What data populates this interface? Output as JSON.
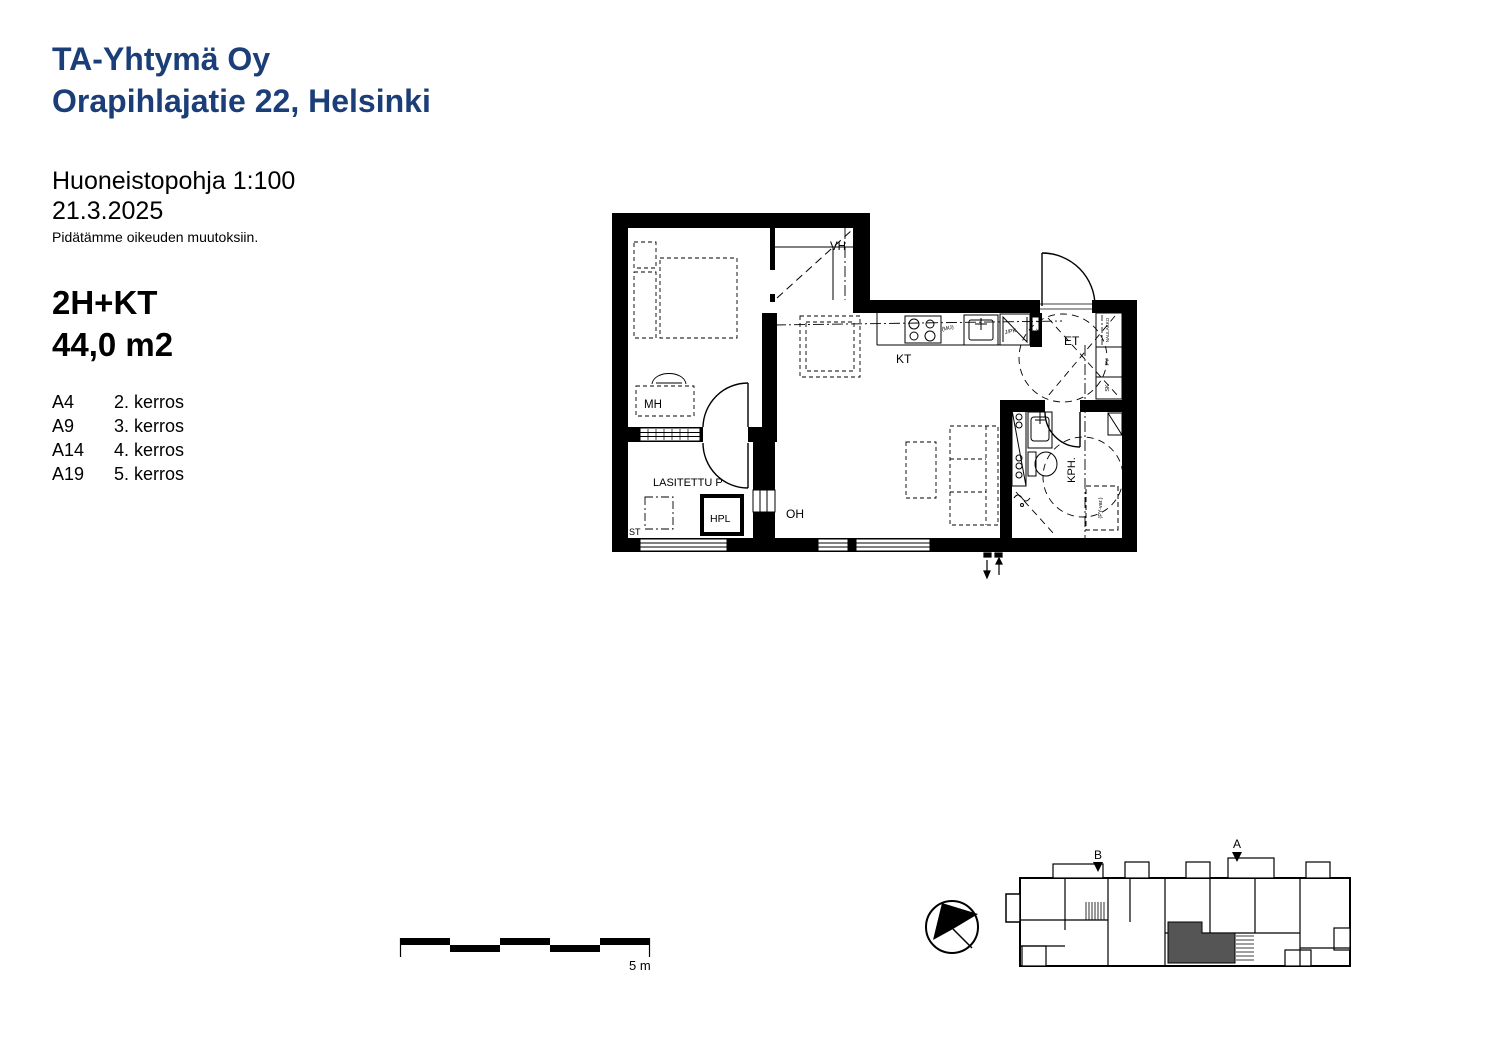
{
  "colors": {
    "brand_blue": "#1b3e78",
    "highlight_gray": "#555555",
    "line_black": "#000000"
  },
  "header": {
    "company": "TA-Yhtymä Oy",
    "address": "Orapihlajatie 22, Helsinki",
    "plan_type": "Huoneistopohja 1:100",
    "date": "21.3.2025",
    "disclaimer": "Pidätämme oikeuden muutoksiin."
  },
  "apartment": {
    "type": "2H+KT",
    "area": "44,0 m2",
    "units": [
      {
        "code": "A4",
        "floor": "2. kerros"
      },
      {
        "code": "A9",
        "floor": "3. kerros"
      },
      {
        "code": "A14",
        "floor": "4. kerros"
      },
      {
        "code": "A19",
        "floor": "5. kerros"
      }
    ]
  },
  "floor_plan": {
    "rooms": {
      "mh": "MH",
      "vh": "VH",
      "kt": "KT",
      "oh": "OH",
      "et": "ET",
      "kph": "KPH.",
      "balcony": "LASITETTU P"
    },
    "fixtures": {
      "hpl": "HPL",
      "st": "ST",
      "mu": "(MU)",
      "jpk": "J/PK",
      "rk": "RK",
      "naulakko": "NAULAKKO",
      "py": "PY",
      "sk": "SK",
      "py_reservation": "(PY-var.)"
    }
  },
  "scale_bar": {
    "label": "5 m"
  },
  "key_plan": {
    "marker_a": "A",
    "marker_b": "B"
  }
}
